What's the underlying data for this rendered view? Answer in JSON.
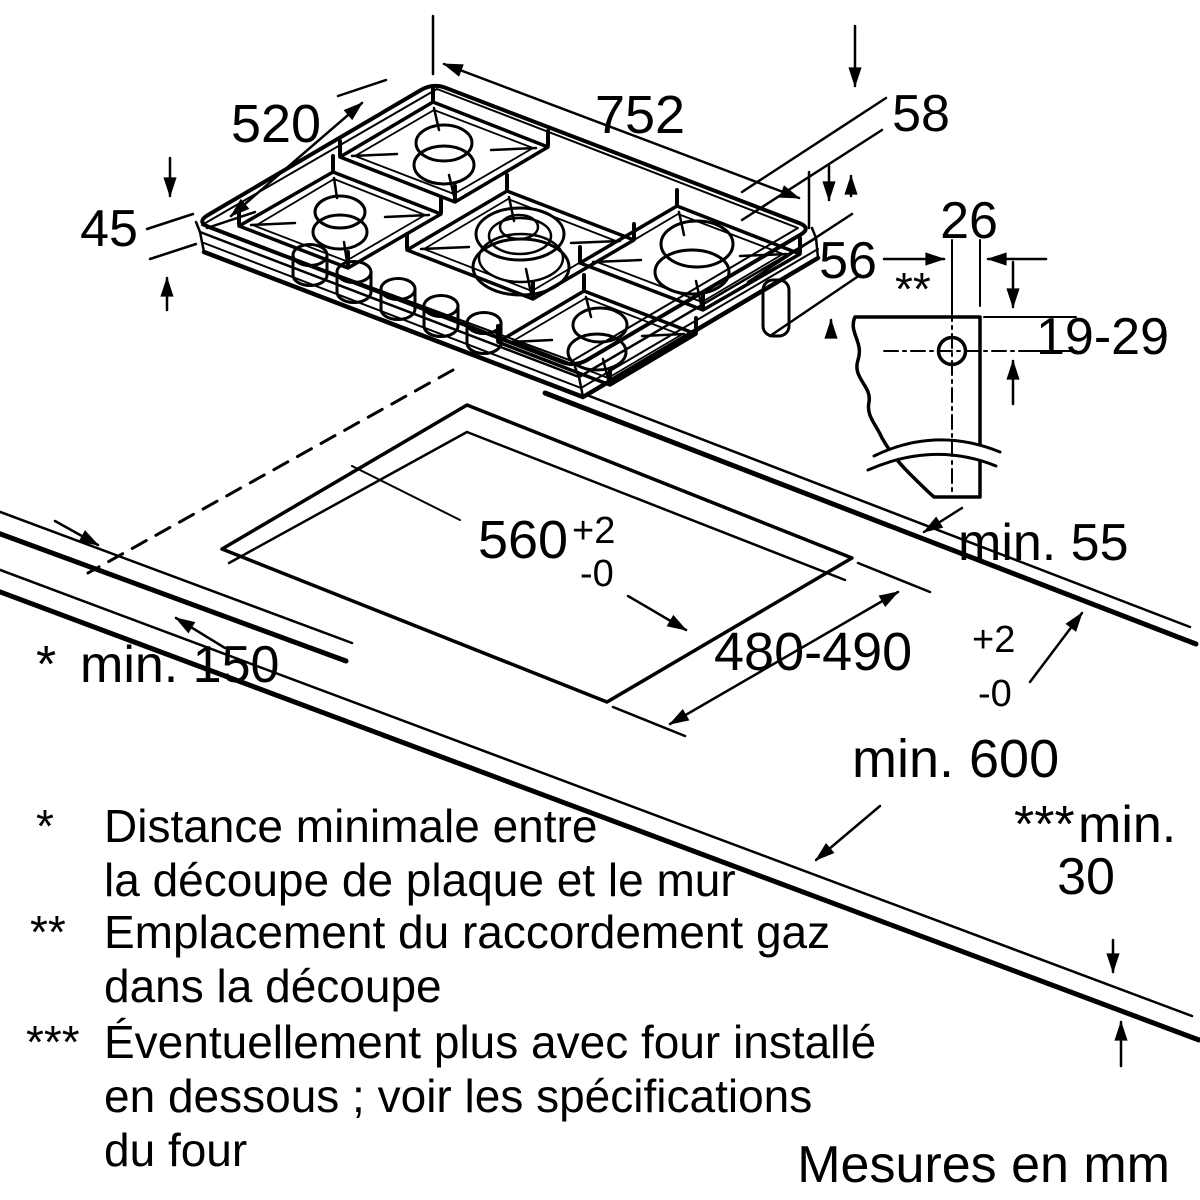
{
  "diagram": {
    "type": "gas-hob-installation-diagram",
    "appliance": {
      "width": "752",
      "depth": "520",
      "height": "45",
      "body_depth": "58",
      "body_clearance": "56"
    },
    "gas_connection": {
      "marker": "**",
      "offset": "26",
      "height_range": "19-29"
    },
    "worktop": {
      "cutout_width": "560",
      "cutout_width_tol_upper": "+2",
      "cutout_width_tol_lower": "-0",
      "cutout_depth": "480-490",
      "cutout_depth_tol_upper": "+2",
      "cutout_depth_tol_lower": "-0",
      "rear_clearance": "min. 55",
      "side_clearance_marker": "*",
      "side_clearance": "min. 150",
      "min_depth": "min. 600",
      "thickness_marker": "***",
      "thickness_prefix": "min.",
      "thickness_value": "30"
    },
    "footnotes": [
      {
        "marker": "*",
        "lines": [
          "Distance minimale entre",
          "la découpe de plaque et le mur"
        ]
      },
      {
        "marker": "**",
        "lines": [
          "Emplacement du raccordement gaz",
          "dans la découpe"
        ]
      },
      {
        "marker": "***",
        "lines": [
          "Éventuellement plus avec four installé",
          "en dessous ; voir les spécifications",
          "du four"
        ]
      }
    ],
    "units_note": "Mesures en mm",
    "colors": {
      "line": "#000000",
      "burner_cap": "#c5c5c5",
      "background": "#ffffff"
    }
  }
}
